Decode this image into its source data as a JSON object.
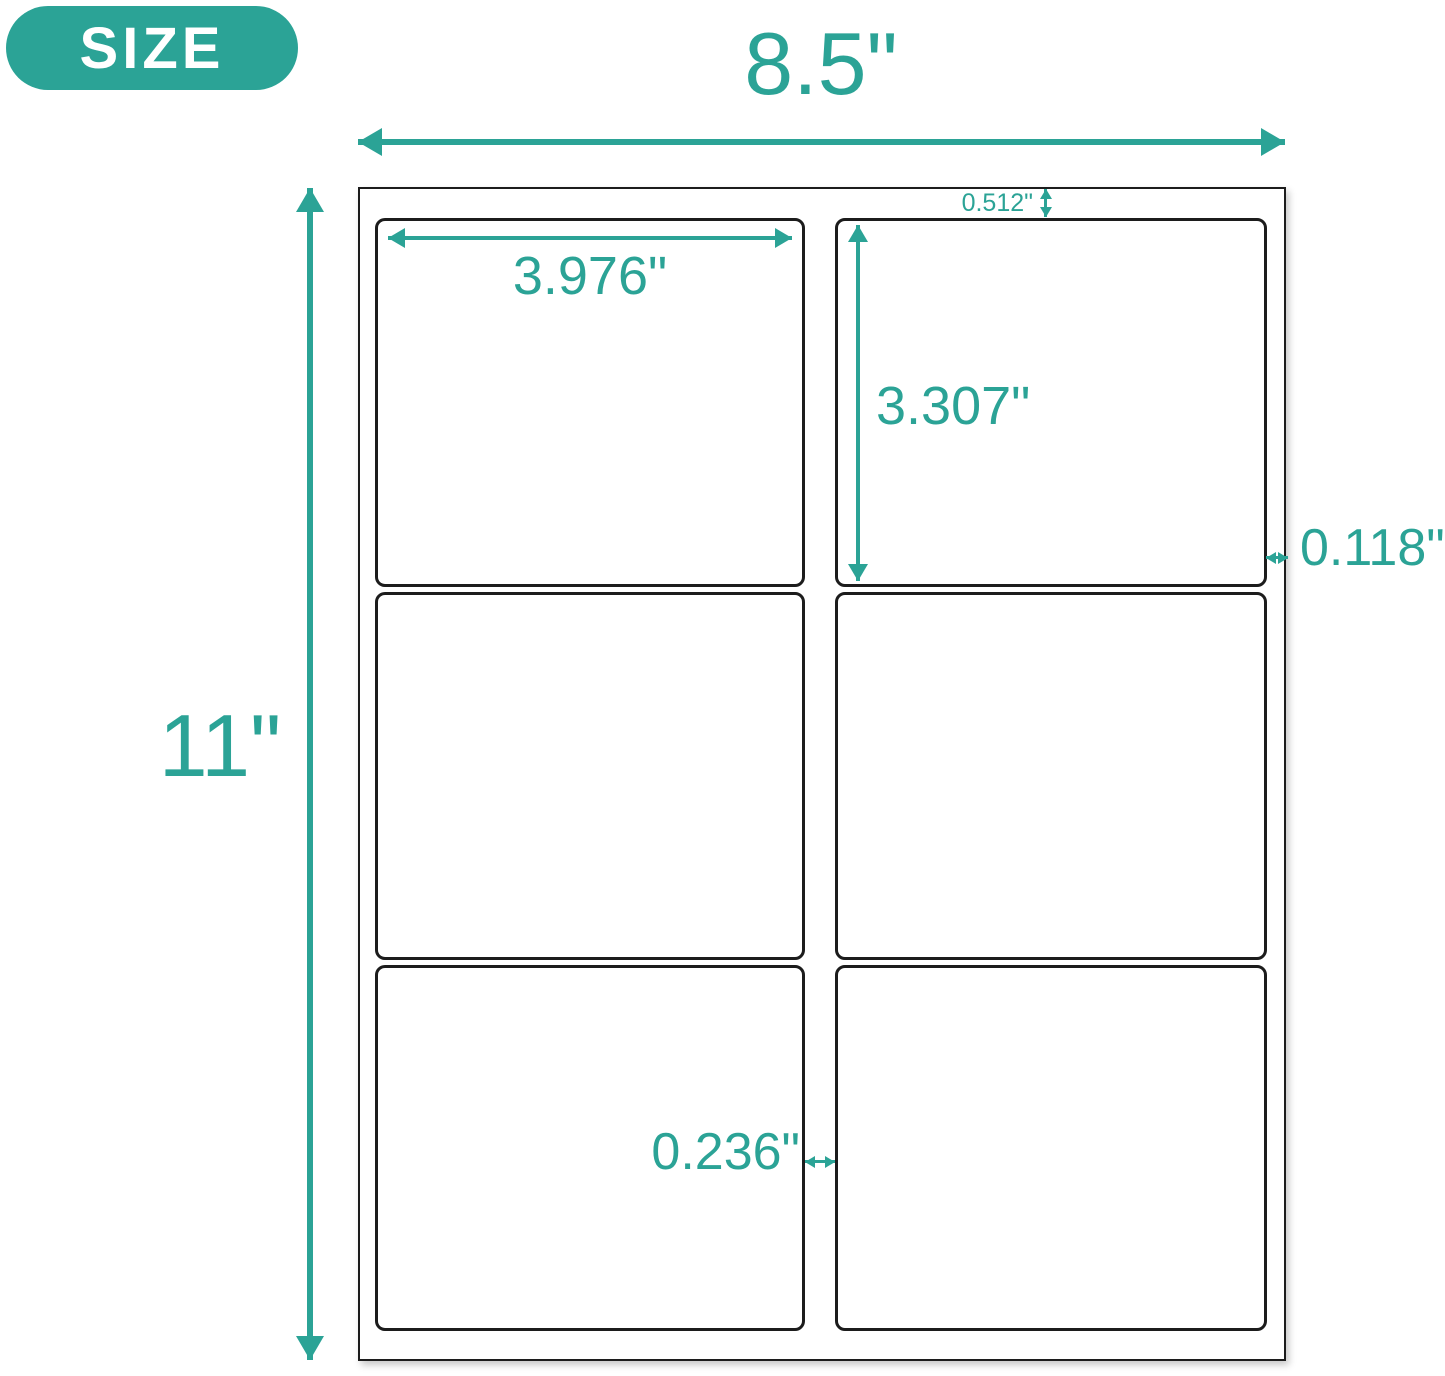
{
  "badge": {
    "label": "SIZE"
  },
  "colors": {
    "accent": "#2BA396",
    "line": "#1C1C1C",
    "background": "#FFFFFF"
  },
  "sheet": {
    "width_label": "8.5\"",
    "height_label": "11\"",
    "columns": 2,
    "rows": 3,
    "label_count": 6
  },
  "annotations": {
    "label_width": "3.976\"",
    "label_height": "3.307\"",
    "top_margin": "0.512\"",
    "side_margin": "0.118\"",
    "column_gap": "0.236\""
  }
}
